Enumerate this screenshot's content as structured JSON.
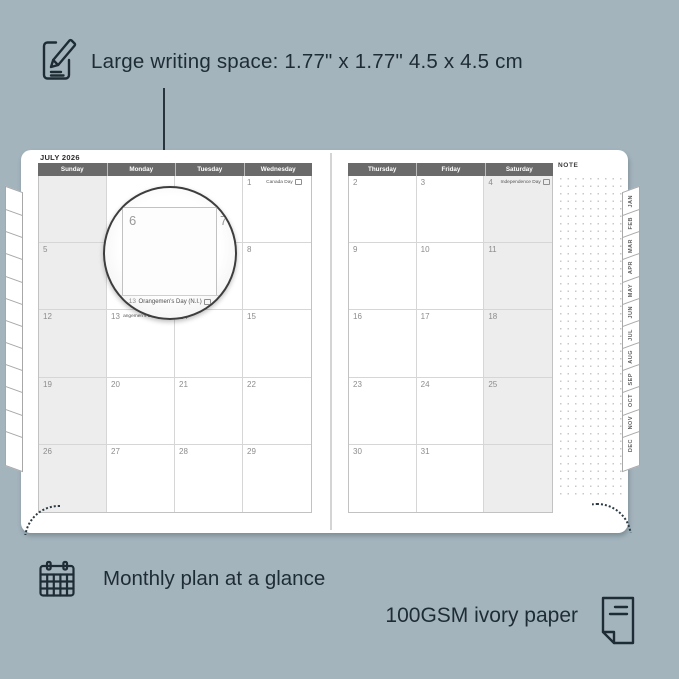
{
  "colors": {
    "background": "#a4b4bd",
    "ink": "#1e2c35",
    "page": "#ffffff",
    "header_bar": "#6a6a6a",
    "weekend_shade": "#ededed",
    "grid_line": "#d6d6d6"
  },
  "annotations": {
    "writing_space": "Large writing space: 1.77\" x 1.77\" 4.5 x 4.5 cm",
    "monthly_plan": "Monthly plan at a glance",
    "paper": "100GSM ivory paper"
  },
  "icons": {
    "top": "note-pencil-icon",
    "bottom_left": "calendar-grid-icon",
    "bottom_right": "paper-sheet-icon"
  },
  "planner": {
    "month_title": "JULY 2026",
    "note_label": "NOTE",
    "month_tabs": [
      "JAN",
      "FEB",
      "MAR",
      "APR",
      "MAY",
      "JUN",
      "JUL",
      "AUG",
      "SEP",
      "OCT",
      "NOV",
      "DEC"
    ],
    "left_page": {
      "headers": [
        "Sunday",
        "Monday",
        "Tuesday",
        "Wednesday"
      ],
      "weekend_col": 0,
      "rows": [
        [
          {
            "day": ""
          },
          {
            "day": ""
          },
          {
            "day": ""
          },
          {
            "day": "1",
            "holiday": "Canada Day"
          }
        ],
        [
          {
            "day": "5"
          },
          {
            "day": "6"
          },
          {
            "day": "7"
          },
          {
            "day": "8"
          }
        ],
        [
          {
            "day": "12"
          },
          {
            "day": "13",
            "holiday": "Orangemen's Day (N.I.)"
          },
          {
            "day": "14"
          },
          {
            "day": "15"
          }
        ],
        [
          {
            "day": "19"
          },
          {
            "day": "20"
          },
          {
            "day": "21"
          },
          {
            "day": "22"
          }
        ],
        [
          {
            "day": "26"
          },
          {
            "day": "27"
          },
          {
            "day": "28"
          },
          {
            "day": "29"
          }
        ]
      ]
    },
    "right_page": {
      "headers": [
        "Thursday",
        "Friday",
        "Saturday"
      ],
      "weekend_col": 2,
      "rows": [
        [
          {
            "day": "2"
          },
          {
            "day": "3"
          },
          {
            "day": "4",
            "holiday": "Independence Day"
          }
        ],
        [
          {
            "day": "9"
          },
          {
            "day": "10"
          },
          {
            "day": "11"
          }
        ],
        [
          {
            "day": "16"
          },
          {
            "day": "17"
          },
          {
            "day": "18"
          }
        ],
        [
          {
            "day": "23"
          },
          {
            "day": "24"
          },
          {
            "day": "25"
          }
        ],
        [
          {
            "day": "30"
          },
          {
            "day": "31"
          },
          {
            "day": ""
          }
        ]
      ]
    },
    "magnifier": {
      "day_left": "6",
      "day_right": "7",
      "footer_day": "13",
      "footer_holiday": "Orangemen's Day (N.I.)"
    }
  }
}
